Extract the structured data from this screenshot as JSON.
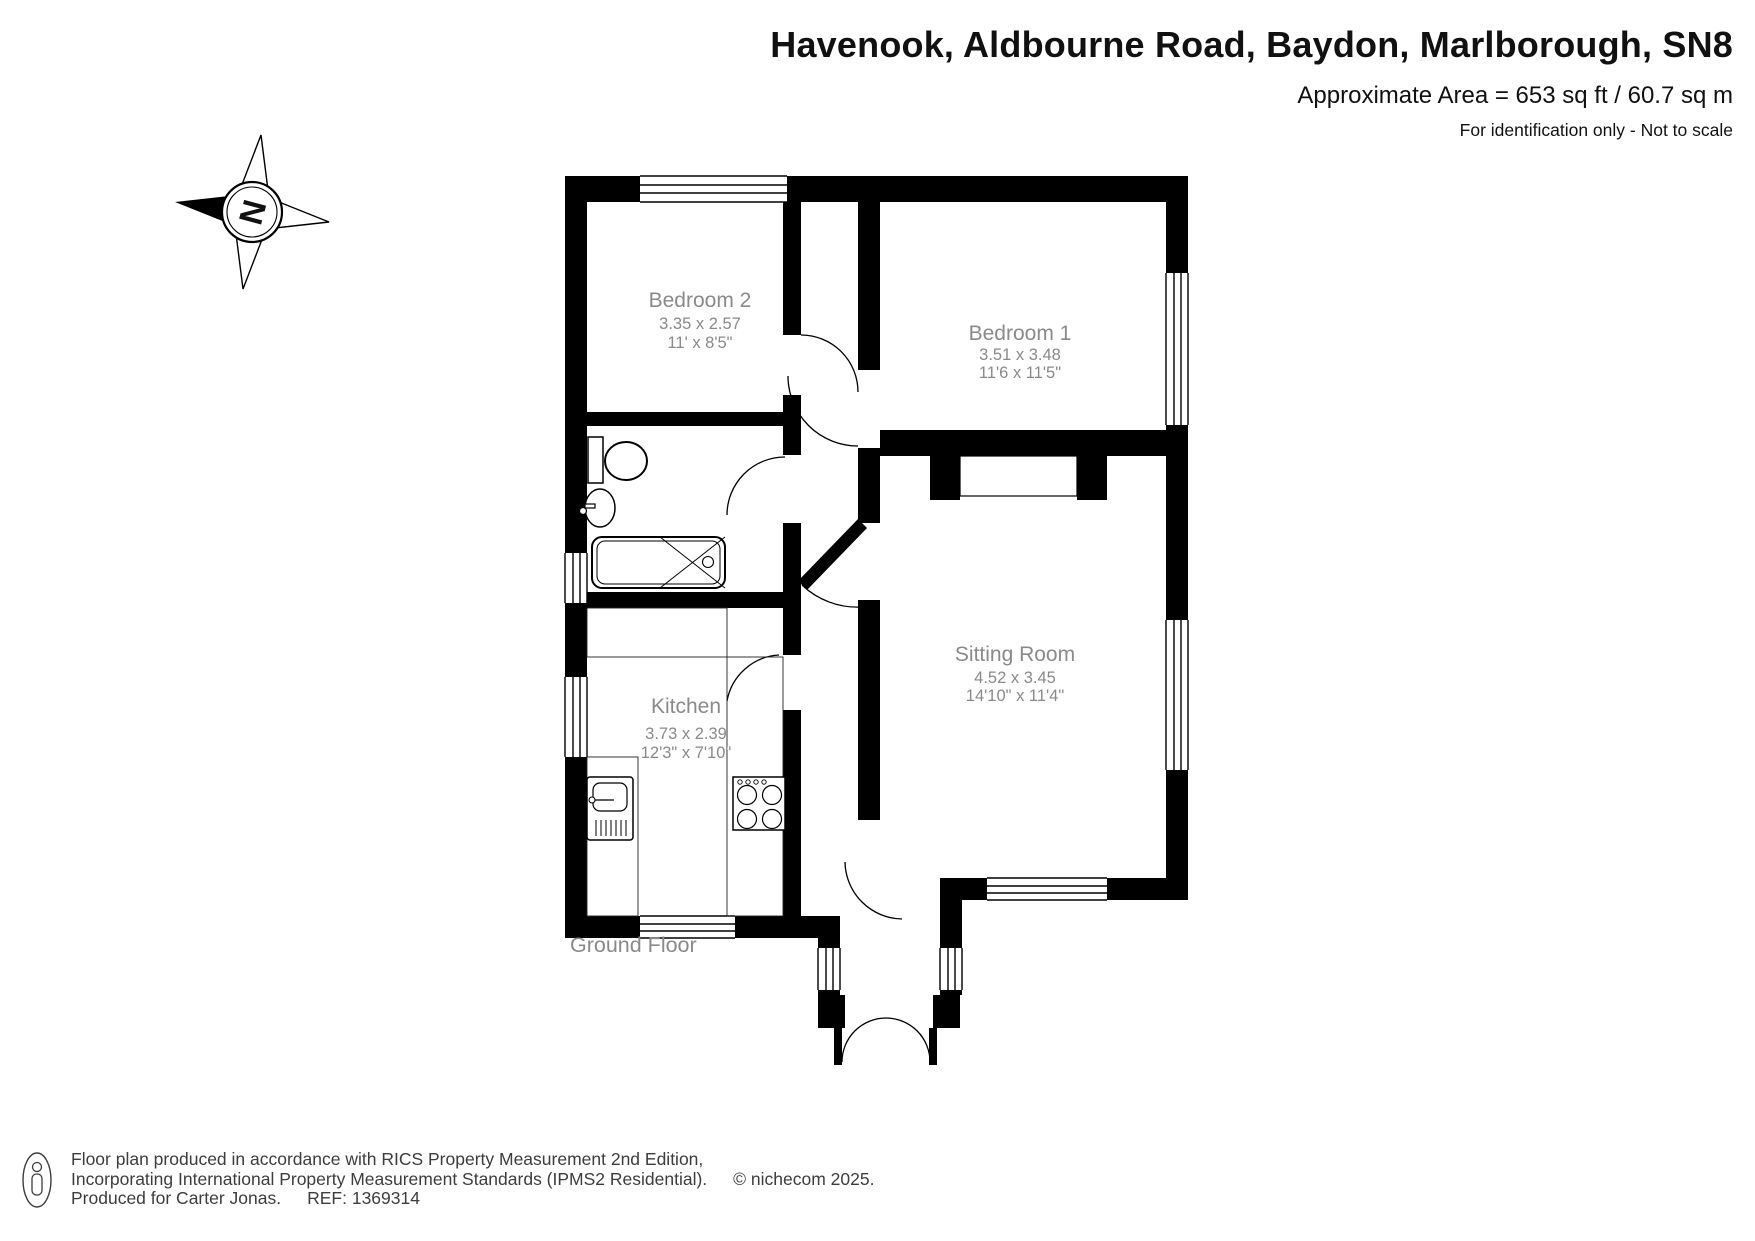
{
  "header": {
    "title": "Havenook, Aldbourne Road, Baydon, Marlborough, SN8",
    "area_line": "Approximate Area = 653 sq ft / 60.7 sq m",
    "disclaimer": "For identification only - Not to scale"
  },
  "compass": {
    "letter": "N"
  },
  "floor_label": "Ground Floor",
  "rooms": [
    {
      "name": "Bedroom 2",
      "metric": "3.35 x 2.57",
      "imperial": "11' x 8'5\""
    },
    {
      "name": "Bedroom 1",
      "metric": "3.51 x 3.48",
      "imperial": "11'6 x 11'5\""
    },
    {
      "name": "Sitting Room",
      "metric": "4.52 x 3.45",
      "imperial": "14'10\" x 11'4\""
    },
    {
      "name": "Kitchen",
      "metric": "3.73 x 2.39",
      "imperial": "12'3\" x 7'10\""
    }
  ],
  "footer": {
    "line1": "Floor plan produced in accordance with RICS Property Measurement 2nd Edition,",
    "line2": "Incorporating International Property Measurement Standards (IPMS2 Residential).",
    "copyright": "© nichecom 2025.",
    "produced_for": "Produced for Carter Jonas.",
    "ref": "REF: 1369314"
  },
  "colors": {
    "wall": "#000000",
    "room_label": "#8a8a8a",
    "text": "#111111",
    "footer_text": "#3d3d3d"
  }
}
